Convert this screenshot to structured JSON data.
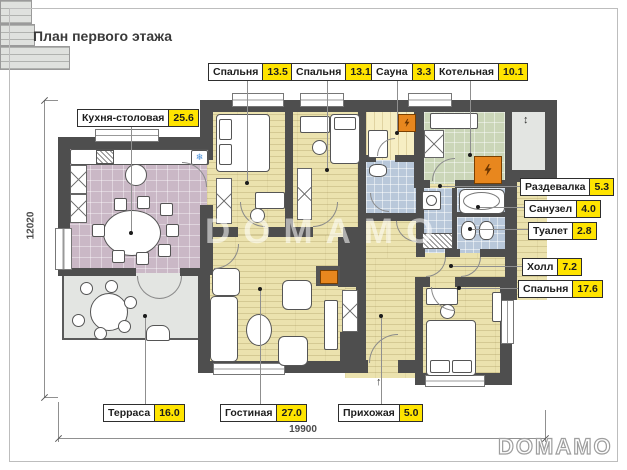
{
  "title": "План первого этажа",
  "watermark": "DOMAMO",
  "logo": "DOMAMO",
  "dimensions": {
    "horizontal": "19900",
    "vertical": "12020"
  },
  "rooms": {
    "bedroom1": {
      "label": "Спальня",
      "area": "13.5"
    },
    "bedroom2": {
      "label": "Спальня",
      "area": "13.1"
    },
    "sauna": {
      "label": "Сауна",
      "area": "3.3"
    },
    "boiler": {
      "label": "Котельная",
      "area": "10.1"
    },
    "kitchen": {
      "label": "Кухня-столовая",
      "area": "25.6"
    },
    "dressing": {
      "label": "Раздевалка",
      "area": "5.3"
    },
    "bathroom": {
      "label": "Санузел",
      "area": "4.0"
    },
    "toilet": {
      "label": "Туалет",
      "area": "2.8"
    },
    "hall": {
      "label": "Холл",
      "area": "7.2"
    },
    "bedroom3": {
      "label": "Спальня",
      "area": "17.6"
    },
    "terrace": {
      "label": "Терраса",
      "area": "16.0"
    },
    "living": {
      "label": "Гостиная",
      "area": "27.0"
    },
    "entry": {
      "label": "Прихожая",
      "area": "5.0"
    }
  },
  "icons": {
    "fridge": "❄",
    "porch_arrow": "↕",
    "entry_arrow": "↑"
  },
  "colors": {
    "wall": "#4e4e4e",
    "area_badge": "#ffe400",
    "wood_floor": "#ebe2ae",
    "kitchen_floor": "#cab8c6",
    "wet_floor": "#b9c8da",
    "boiler_floor": "#cbd6b8",
    "sauna_floor": "#f6eec3",
    "terrace_floor": "#e3e5e2",
    "equipment_orange": "#e8871e"
  }
}
